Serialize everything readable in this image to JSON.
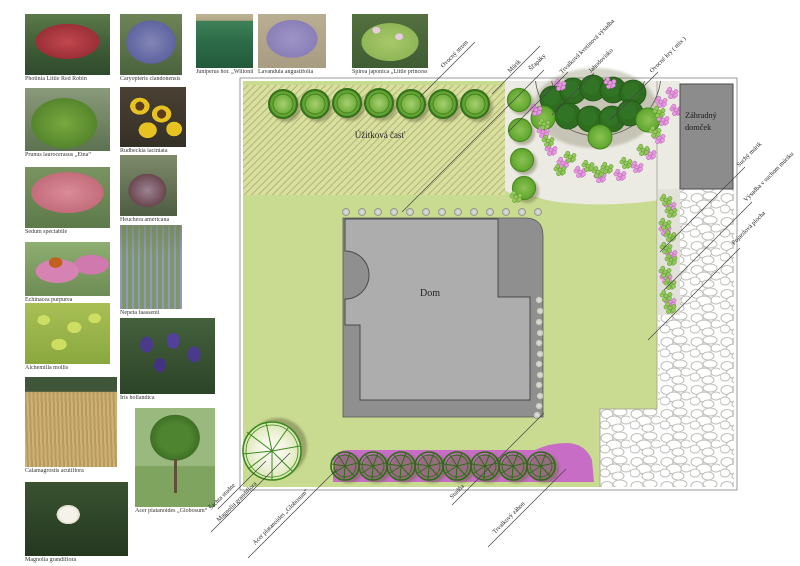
{
  "legend": {
    "items": [
      {
        "id": "photinia",
        "label": "Photinia Little Red Robin"
      },
      {
        "id": "caryopteris",
        "label": "Caryopteris clandonensis"
      },
      {
        "id": "juniperus",
        "label": "Juniperus hor. „Wiltonii“"
      },
      {
        "id": "lavandula",
        "label": "Lavandula angustifolia"
      },
      {
        "id": "spirea",
        "label": "Spirea japonica „Little princess“"
      },
      {
        "id": "prunus",
        "label": "Prunus laurocerasus „Etna“"
      },
      {
        "id": "rudbeckia",
        "label": "Rudbeckia laciniata"
      },
      {
        "id": "sedum",
        "label": "Sedum spectabile"
      },
      {
        "id": "heuchera",
        "label": "Heuchera americana"
      },
      {
        "id": "echinacea",
        "label": "Echinacea purpurea"
      },
      {
        "id": "nepeta",
        "label": "Nepeta faassenii"
      },
      {
        "id": "alchemilla",
        "label": "Alchemilla mollis"
      },
      {
        "id": "iris",
        "label": "Iris hollandica"
      },
      {
        "id": "calamagrostis",
        "label": "Calamagrostis acutiflora"
      },
      {
        "id": "acer",
        "label": "Acer platanoides „Globosum“"
      },
      {
        "id": "magnolia",
        "label": "Magnolia grandiflora"
      }
    ]
  },
  "plan": {
    "utility_label": "Úžitková časť",
    "house_label": "Dom",
    "shed_label_lines": [
      "Záhradný",
      "domček"
    ],
    "callouts": {
      "top": [
        "Ovocný strom",
        "Múrik",
        "Šľapáky",
        "Trvalková kvetinová výsadba",
        "Jahodovisko",
        "Ovocné kry ( mix )"
      ],
      "right": [
        "Suchý múrik",
        "Výsadba v suchom múriku",
        "Pojazdová plocha"
      ],
      "bottom": [
        "Šachta studne",
        "Magnolia grandiflora",
        "Acer platanoides „Globosum“",
        "Studňa",
        "Trvalkový záhon"
      ]
    }
  },
  "colors": {
    "lawn": "#c9db90",
    "utility_hatch_bg": "#d8e09e",
    "utility_hatch_line": "#b3ab74",
    "gravel": "#ebeae3",
    "house": "#adadad",
    "terrace": "#8f8f8f",
    "shed": "#8c8c8c",
    "tree_ring": "#34711a",
    "dark_tree": "#2e6c20",
    "medium_tree": "#5da52c",
    "pink_flower": "#e79ae0",
    "green_flower": "#94c95e",
    "perennial_bed": "#c76dc5",
    "stepping_stone": "#d2d2cd"
  }
}
